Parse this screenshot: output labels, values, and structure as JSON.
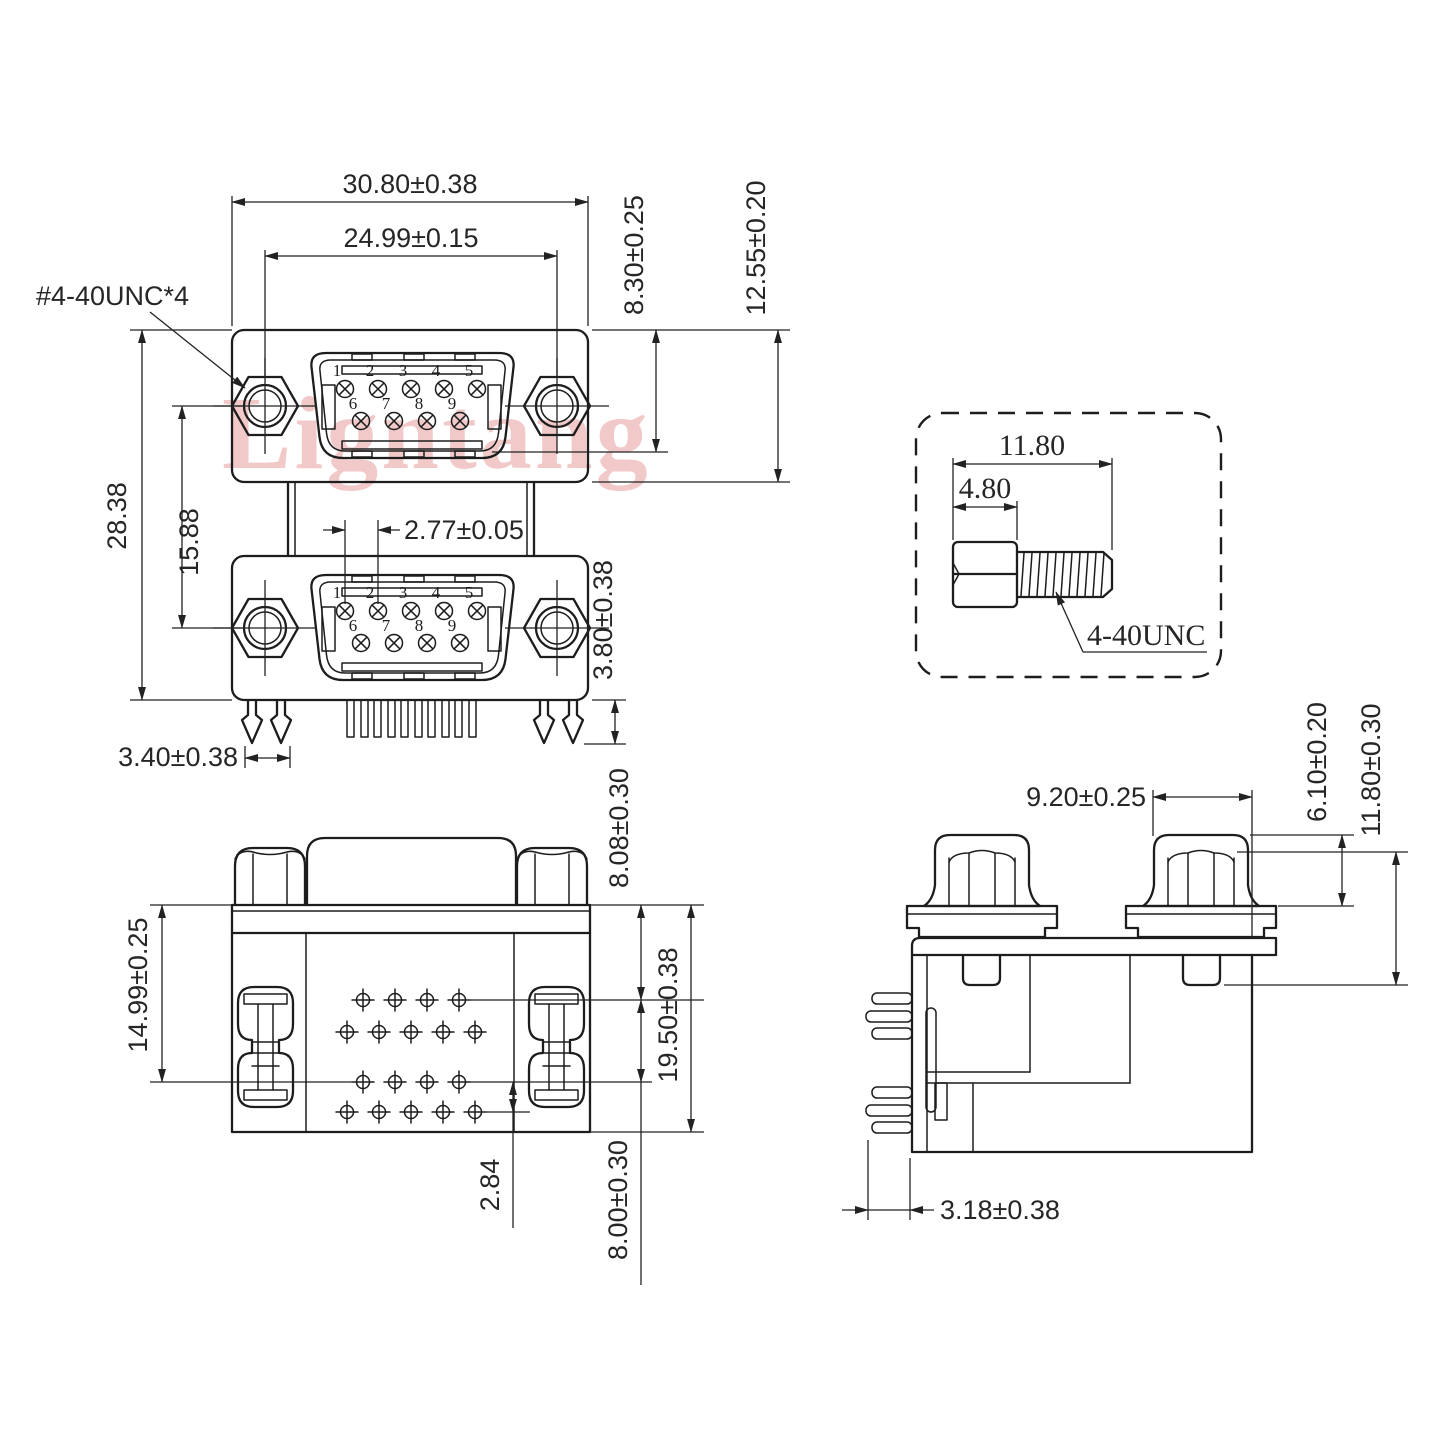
{
  "colors": {
    "line": "#1d1d1d",
    "dim_text": "#262626",
    "watermark_pink": "#eaa9a9",
    "background": "#ffffff"
  },
  "watermark": "Ligntang",
  "front_view": {
    "thread_callout": "#4-40UNC*4",
    "pin_numbers": [
      "1",
      "2",
      "3",
      "4",
      "5",
      "6",
      "7",
      "8",
      "9"
    ],
    "dims": {
      "overall_width": "30.80±0.38",
      "mount_hole_span": "24.99±0.15",
      "shell_to_flange_top": "8.30±0.25",
      "flange_height": "12.55±0.20",
      "overall_height": "28.38",
      "port_center_spacing": "15.88",
      "pin_pitch": "2.77±0.05",
      "solder_pin_length": "3.80±0.38",
      "boardlock_width": "3.40±0.38"
    }
  },
  "screw_detail": {
    "dims": {
      "overall_length": "11.80",
      "head_length": "4.80"
    },
    "thread_label": "4-40UNC"
  },
  "bottom_view": {
    "dims": {
      "flange_to_row1": "8.08±0.30",
      "flange_to_row3": "14.99±0.25",
      "flange_to_bottom": "19.50±0.38",
      "row_pitch": "2.84",
      "row_offset": "8.00±0.30"
    }
  },
  "side_view": {
    "dims": {
      "bracket_depth": "9.20±0.25",
      "nut_height": "6.10±0.20",
      "standoff_length": "11.80±0.30",
      "pin_to_face": "3.18±0.38"
    }
  }
}
